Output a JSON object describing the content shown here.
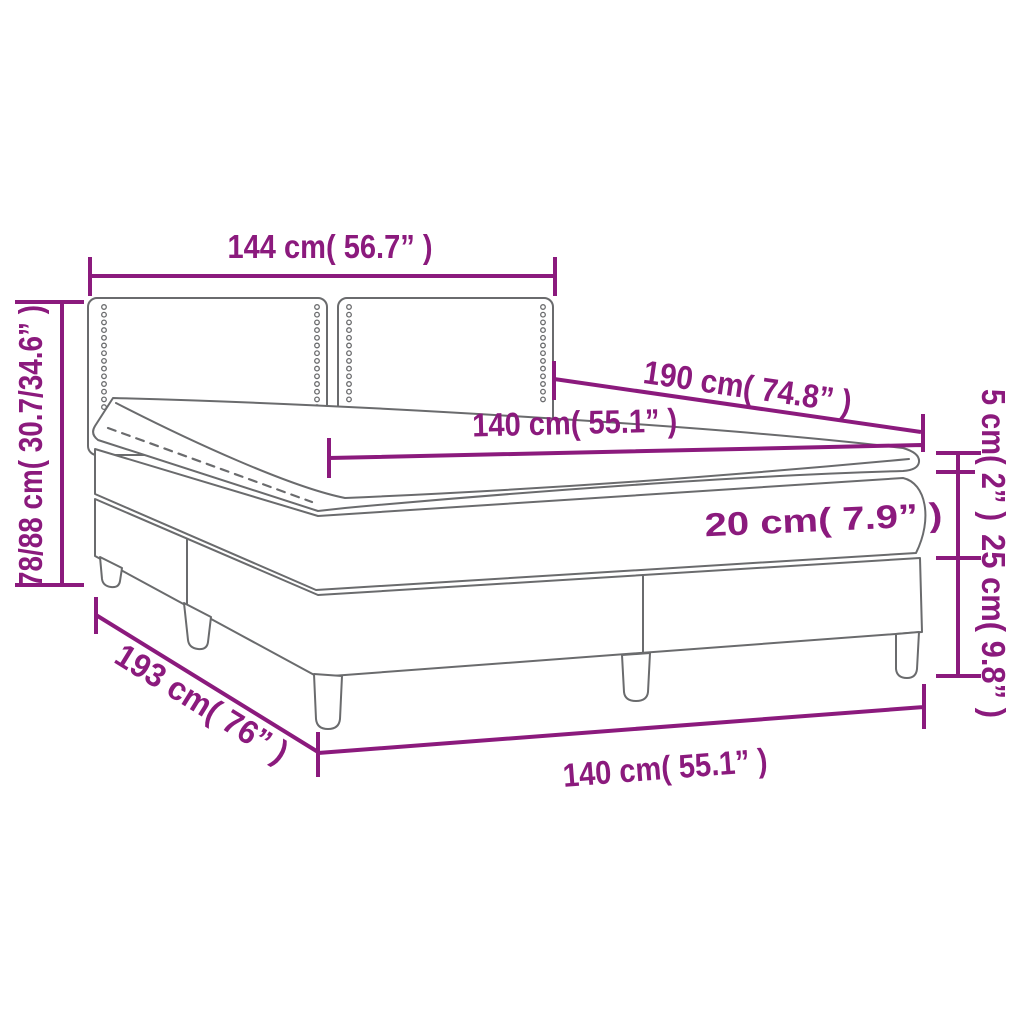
{
  "diagram": {
    "title": "Box spring bed with topper — dimension diagram",
    "colors": {
      "dimension": "#8B1A7D",
      "outline": "#6A6B6D",
      "background": "#FFFFFF"
    },
    "dimensions": {
      "headboard_width": {
        "label": "144 cm( 56.7” )",
        "cm": "144",
        "inches": "56.7"
      },
      "total_height": {
        "label": "78/88 cm( 30.7/34.6” )",
        "cm": "78/88",
        "inches": "30.7/34.6"
      },
      "bed_length": {
        "label": "190 cm( 74.8” )",
        "cm": "190",
        "inches": "74.8"
      },
      "mattress_width": {
        "label": "140 cm( 55.1” )",
        "cm": "140",
        "inches": "55.1"
      },
      "topper_height": {
        "label": "5 cm( 2” )",
        "cm": "5",
        "inches": "2"
      },
      "mattress_height": {
        "label": "20 cm( 7.9” )",
        "cm": "20",
        "inches": "7.9"
      },
      "base_height": {
        "label": "25 cm( 9.8” )",
        "cm": "25",
        "inches": "9.8"
      },
      "base_length": {
        "label": "193 cm( 76” )",
        "cm": "193",
        "inches": "76"
      },
      "base_width": {
        "label": "140 cm( 55.1” )",
        "cm": "140",
        "inches": "55.1"
      }
    }
  }
}
